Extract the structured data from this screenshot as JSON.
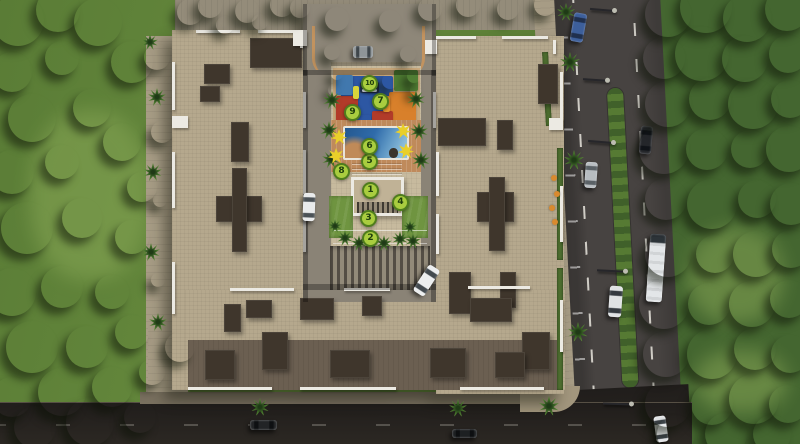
{
  "scene": {
    "title": "Aerial 3D site plan of residential apartment complex with numbered amenities",
    "palette": {
      "lawn": "#5c7e37",
      "forest": "#446630",
      "roof": "#b5a88d",
      "roof_dark": "#3f362c",
      "parapet_white": "#eceae3",
      "road_east": "#474341",
      "road_south": "#221f1c",
      "pool_blue": "#2f6baa",
      "deck_terracotta": "#bf8a5b",
      "marker_green": "#a9cd3f",
      "marker_ring": "#4f7d1d",
      "shade_sail_yellow": "#e9cf2a",
      "playground_blue": "#2d57a3",
      "playground_orange": "#d8802b",
      "playground_red": "#b23b29"
    },
    "amenity_markers": [
      {
        "number": "1",
        "x": 370,
        "y": 190
      },
      {
        "number": "2",
        "x": 370,
        "y": 238
      },
      {
        "number": "3",
        "x": 368,
        "y": 218
      },
      {
        "number": "4",
        "x": 400,
        "y": 202
      },
      {
        "number": "5",
        "x": 369,
        "y": 161
      },
      {
        "number": "6",
        "x": 369,
        "y": 146
      },
      {
        "number": "7",
        "x": 380,
        "y": 101
      },
      {
        "number": "8",
        "x": 341,
        "y": 171
      },
      {
        "number": "9",
        "x": 352,
        "y": 112
      },
      {
        "number": "10",
        "x": 369,
        "y": 83
      }
    ],
    "vehicles": [
      {
        "name": "blue-sedan-road-east",
        "x": 572,
        "y": 13,
        "w": 13,
        "h": 29,
        "rot": 10,
        "body": "#3d5f9b",
        "glass": "#20304e",
        "dir": "v"
      },
      {
        "name": "black-sedan-road-east",
        "x": 640,
        "y": 126,
        "w": 12,
        "h": 28,
        "rot": 5,
        "body": "#24262a",
        "glass": "#101318",
        "dir": "v"
      },
      {
        "name": "silver-sedan-road-east",
        "x": 585,
        "y": 162,
        "w": 12,
        "h": 26,
        "rot": 4,
        "body": "#b7bcc0",
        "glass": "#5a6166",
        "dir": "v"
      },
      {
        "name": "white-bus-road-east",
        "x": 648,
        "y": 234,
        "w": 16,
        "h": 68,
        "rot": 4,
        "body": "#e3e6e8",
        "glass": "#2c3338",
        "dir": "v",
        "kind": "bus"
      },
      {
        "name": "white-van-road-east",
        "x": 609,
        "y": 286,
        "w": 13,
        "h": 31,
        "rot": 4,
        "body": "#dfe2e4",
        "glass": "#343a40",
        "dir": "v"
      },
      {
        "name": "white-car-road-east-south",
        "x": 655,
        "y": 416,
        "w": 12,
        "h": 26,
        "rot": -8,
        "body": "#e6e8ea",
        "glass": "#3c4247",
        "dir": "v"
      },
      {
        "name": "grey-car-entry-plaza",
        "x": 353,
        "y": 46,
        "w": 20,
        "h": 12,
        "rot": 0,
        "body": "#8f9598",
        "glass": "#3f464b",
        "dir": "h"
      },
      {
        "name": "white-car-courtyard-west",
        "x": 303,
        "y": 193,
        "w": 12,
        "h": 28,
        "rot": 2,
        "body": "#e8eaeb",
        "glass": "#4a5156",
        "dir": "v"
      },
      {
        "name": "white-car-courtyard-east",
        "x": 420,
        "y": 265,
        "w": 13,
        "h": 31,
        "rot": 33,
        "body": "#eceeef",
        "glass": "#434a4f",
        "dir": "v"
      },
      {
        "name": "dark-car-road-south",
        "x": 250,
        "y": 420,
        "w": 27,
        "h": 10,
        "rot": 0,
        "body": "#222426",
        "glass": "#0e1012",
        "dir": "h"
      },
      {
        "name": "dark-car-road-south-2",
        "x": 452,
        "y": 429,
        "w": 25,
        "h": 9,
        "rot": 0,
        "body": "#1d2022",
        "glass": "#0d0f11",
        "dir": "h"
      }
    ],
    "lamps": [
      {
        "x": 590,
        "y": 9,
        "len": 26,
        "rot": 5
      },
      {
        "x": 583,
        "y": 79,
        "len": 26,
        "rot": 4
      },
      {
        "x": 588,
        "y": 141,
        "len": 27,
        "rot": 5
      },
      {
        "x": 597,
        "y": 270,
        "len": 30,
        "rot": 3
      },
      {
        "x": 603,
        "y": 403,
        "len": 30,
        "rot": 2
      }
    ],
    "trees": [
      [
        18,
        20,
        26,
        0
      ],
      [
        58,
        10,
        22,
        0
      ],
      [
        98,
        22,
        24,
        0
      ],
      [
        12,
        72,
        20,
        0
      ],
      [
        62,
        58,
        17,
        2
      ],
      [
        132,
        62,
        21,
        0
      ],
      [
        32,
        118,
        24,
        0
      ],
      [
        92,
        108,
        19,
        0
      ],
      [
        12,
        172,
        22,
        0
      ],
      [
        62,
        162,
        17,
        2
      ],
      [
        122,
        142,
        19,
        0
      ],
      [
        142,
        187,
        15,
        0
      ],
      [
        27,
        228,
        26,
        0
      ],
      [
        82,
        218,
        20,
        0
      ],
      [
        132,
        237,
        17,
        0
      ],
      [
        12,
        292,
        24,
        0
      ],
      [
        62,
        287,
        21,
        0
      ],
      [
        112,
        292,
        17,
        0
      ],
      [
        32,
        347,
        26,
        0
      ],
      [
        87,
        347,
        21,
        0
      ],
      [
        132,
        332,
        17,
        0
      ],
      [
        12,
        397,
        20,
        1
      ],
      [
        62,
        392,
        24,
        1
      ],
      [
        112,
        387,
        20,
        1
      ],
      [
        152,
        372,
        13,
        0
      ],
      [
        157,
        57,
        13,
        0
      ],
      [
        162,
        132,
        11,
        0
      ],
      [
        90,
        422,
        24,
        1
      ],
      [
        35,
        427,
        21,
        1
      ],
      [
        140,
        417,
        16,
        1
      ],
      [
        180,
        347,
        15,
        0
      ],
      [
        190,
        12,
        13,
        3
      ],
      [
        210,
        6,
        12,
        0
      ],
      [
        247,
        11,
        12,
        0
      ],
      [
        282,
        5,
        12,
        0
      ],
      [
        300,
        8,
        10,
        0
      ],
      [
        337,
        19,
        12,
        0
      ],
      [
        390,
        21,
        11,
        0
      ],
      [
        430,
        9,
        12,
        0
      ],
      [
        468,
        5,
        12,
        0
      ],
      [
        508,
        9,
        11,
        0
      ],
      [
        545,
        5,
        11,
        0
      ],
      [
        225,
        25,
        9,
        4
      ],
      [
        260,
        22,
        8,
        4
      ],
      [
        668,
        14,
        23,
        1
      ],
      [
        706,
        7,
        26,
        1
      ],
      [
        747,
        18,
        24,
        1
      ],
      [
        787,
        9,
        22,
        1
      ],
      [
        664,
        58,
        21,
        1
      ],
      [
        702,
        54,
        27,
        0
      ],
      [
        745,
        59,
        23,
        1
      ],
      [
        788,
        54,
        19,
        1
      ],
      [
        668,
        104,
        23,
        1
      ],
      [
        710,
        99,
        21,
        0
      ],
      [
        753,
        104,
        25,
        1
      ],
      [
        790,
        99,
        19,
        1
      ],
      [
        664,
        149,
        25,
        1
      ],
      [
        707,
        149,
        21,
        1
      ],
      [
        750,
        149,
        19,
        0
      ],
      [
        789,
        149,
        23,
        1
      ],
      [
        666,
        199,
        21,
        1
      ],
      [
        712,
        204,
        25,
        0
      ],
      [
        757,
        199,
        19,
        1
      ],
      [
        791,
        204,
        21,
        1
      ],
      [
        668,
        254,
        23,
        1
      ],
      [
        715,
        254,
        19,
        0
      ],
      [
        756,
        254,
        23,
        1
      ],
      [
        791,
        249,
        19,
        1
      ],
      [
        664,
        304,
        25,
        1
      ],
      [
        709,
        304,
        21,
        0
      ],
      [
        752,
        304,
        23,
        1
      ],
      [
        789,
        299,
        19,
        1
      ],
      [
        666,
        354,
        23,
        1
      ],
      [
        712,
        354,
        25,
        1
      ],
      [
        755,
        349,
        21,
        0
      ],
      [
        790,
        354,
        19,
        1
      ],
      [
        668,
        404,
        23,
        1
      ],
      [
        712,
        404,
        21,
        1
      ],
      [
        754,
        399,
        25,
        1
      ],
      [
        788,
        404,
        19,
        1
      ],
      [
        676,
        434,
        19,
        1
      ],
      [
        726,
        434,
        21,
        1
      ],
      [
        772,
        434,
        19,
        1
      ],
      [
        332,
        52,
        8,
        4
      ],
      [
        408,
        54,
        8,
        4
      ],
      [
        334,
        90,
        6,
        4
      ],
      [
        416,
        90,
        6,
        4
      ],
      [
        390,
        81,
        8,
        3
      ],
      [
        414,
        76,
        7,
        4
      ],
      [
        337,
        74,
        6,
        4
      ],
      [
        160,
        200,
        7,
        4
      ],
      [
        158,
        280,
        7,
        4
      ]
    ],
    "palms": [
      [
        332,
        100,
        9
      ],
      [
        329,
        130,
        9
      ],
      [
        331,
        159,
        9
      ],
      [
        416,
        99,
        9
      ],
      [
        419,
        131,
        9
      ],
      [
        421,
        160,
        9
      ],
      [
        345,
        238,
        8
      ],
      [
        359,
        243,
        8
      ],
      [
        384,
        243,
        8
      ],
      [
        400,
        239,
        8
      ],
      [
        413,
        241,
        8
      ],
      [
        335,
        226,
        7
      ],
      [
        410,
        227,
        7
      ],
      [
        570,
        62,
        10
      ],
      [
        574,
        160,
        10
      ],
      [
        578,
        332,
        10
      ],
      [
        549,
        406,
        10
      ],
      [
        458,
        408,
        9
      ],
      [
        260,
        407,
        9
      ],
      [
        566,
        12,
        9
      ],
      [
        157,
        97,
        9
      ],
      [
        153,
        172,
        9
      ],
      [
        151,
        252,
        9
      ],
      [
        158,
        322,
        9
      ],
      [
        150,
        42,
        8
      ]
    ],
    "shade_sails_yellow": [
      [
        339,
        137,
        8
      ],
      [
        336,
        156,
        8
      ],
      [
        403,
        131,
        8
      ],
      [
        406,
        151,
        8
      ]
    ],
    "flower_dots": [
      [
        554,
        178,
        3
      ],
      [
        557,
        194,
        3
      ],
      [
        552,
        208,
        3
      ],
      [
        555,
        222,
        3
      ]
    ],
    "building": {
      "roof_dark_patches": [
        [
          250,
          38,
          52,
          30
        ],
        [
          204,
          64,
          26,
          20
        ],
        [
          200,
          86,
          20,
          16
        ],
        [
          231,
          122,
          18,
          40
        ],
        [
          216,
          196,
          46,
          26
        ],
        [
          232,
          168,
          15,
          84
        ],
        [
          224,
          304,
          17,
          28
        ],
        [
          246,
          300,
          26,
          18
        ],
        [
          438,
          118,
          48,
          28
        ],
        [
          497,
          120,
          16,
          30
        ],
        [
          477,
          192,
          37,
          30
        ],
        [
          489,
          177,
          16,
          74
        ],
        [
          449,
          272,
          22,
          42
        ],
        [
          500,
          272,
          16,
          36
        ],
        [
          538,
          64,
          20,
          40
        ],
        [
          300,
          298,
          34,
          22
        ],
        [
          362,
          296,
          20,
          20
        ],
        [
          470,
          298,
          42,
          24
        ],
        [
          522,
          332,
          28,
          38
        ],
        [
          262,
          332,
          26,
          38
        ],
        [
          205,
          350,
          30,
          30
        ],
        [
          330,
          350,
          40,
          28
        ],
        [
          430,
          348,
          36,
          30
        ],
        [
          495,
          352,
          30,
          26
        ]
      ],
      "roof_parapets": [
        [
          196,
          30,
          44,
          3
        ],
        [
          258,
          30,
          46,
          3
        ],
        [
          300,
          32,
          3,
          16
        ],
        [
          436,
          36,
          40,
          3
        ],
        [
          502,
          36,
          46,
          3
        ],
        [
          553,
          40,
          3,
          14
        ],
        [
          172,
          62,
          3,
          48
        ],
        [
          172,
          152,
          3,
          56
        ],
        [
          172,
          262,
          3,
          52
        ],
        [
          560,
          72,
          3,
          56
        ],
        [
          560,
          186,
          3,
          56
        ],
        [
          560,
          300,
          3,
          52
        ],
        [
          303,
          92,
          3,
          36
        ],
        [
          303,
          150,
          3,
          44
        ],
        [
          303,
          212,
          3,
          40
        ],
        [
          433,
          92,
          3,
          36
        ],
        [
          436,
          152,
          3,
          44
        ],
        [
          436,
          214,
          3,
          40
        ],
        [
          230,
          288,
          64,
          3
        ],
        [
          344,
          288,
          46,
          3
        ],
        [
          468,
          286,
          62,
          3
        ],
        [
          188,
          387,
          84,
          3
        ],
        [
          300,
          387,
          96,
          3
        ],
        [
          460,
          387,
          84,
          3
        ],
        [
          293,
          30,
          14,
          16
        ],
        [
          425,
          40,
          12,
          14
        ],
        [
          172,
          116,
          16,
          12
        ],
        [
          549,
          118,
          14,
          12
        ]
      ],
      "inner_shadows": [
        [
          303,
          70,
          5,
          232
        ],
        [
          431,
          70,
          5,
          232
        ],
        [
          303,
          70,
          133,
          5
        ],
        [
          303,
          284,
          133,
          6
        ],
        [
          331,
          62,
          90,
          4
        ],
        [
          303,
          4,
          4,
          72
        ],
        [
          432,
          4,
          4,
          72
        ]
      ],
      "playground_patches": [
        [
          341,
          76,
          52,
          46,
          "#2d57a3"
        ],
        [
          389,
          92,
          27,
          36,
          "#d8802b"
        ],
        [
          336,
          96,
          22,
          29,
          "#b23b29"
        ],
        [
          336,
          75,
          17,
          20,
          "#4178ae"
        ],
        [
          394,
          70,
          24,
          21,
          "#507e34"
        ],
        [
          372,
          111,
          21,
          16,
          "#b23b29"
        ],
        [
          352,
          115,
          19,
          13,
          "#2d57a3"
        ],
        [
          360,
          82,
          19,
          11,
          "#23304d"
        ],
        [
          362,
          84,
          15,
          3,
          "#cfd6dc"
        ],
        [
          362,
          89,
          15,
          3,
          "#cfd6dc"
        ],
        [
          353,
          86,
          6,
          13,
          "#d8d43a"
        ],
        [
          383,
          96,
          7,
          16,
          "#e8952f"
        ]
      ]
    }
  }
}
